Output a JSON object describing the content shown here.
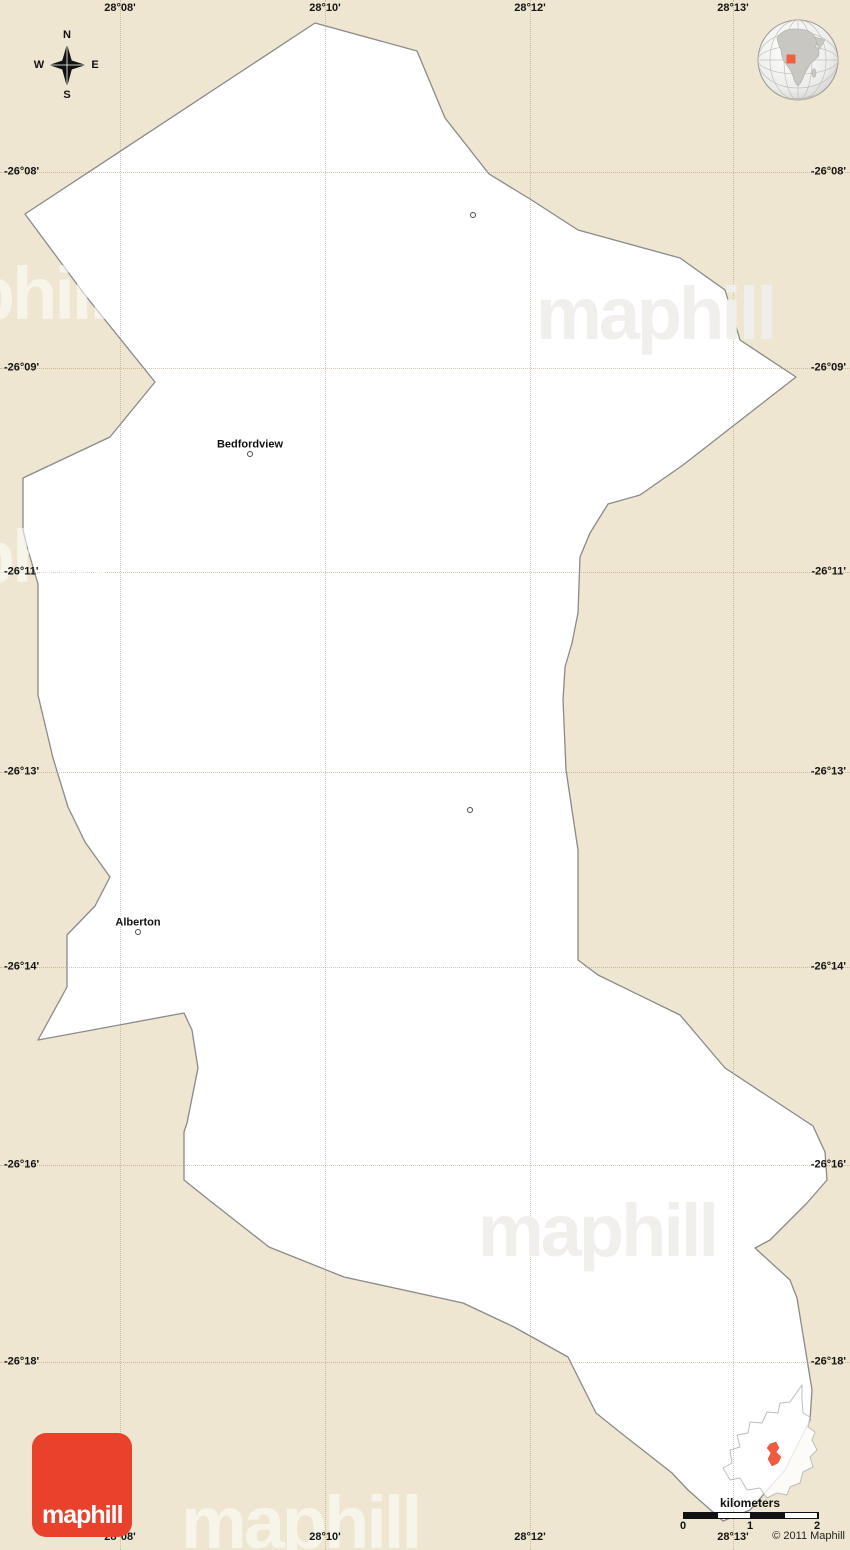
{
  "colors": {
    "background": "#EEE6D0",
    "region_fill": "#FFFFFF",
    "region_stroke": "#8A8A8C",
    "accent_red": "#E8422D",
    "highlight_red": "#F15B40"
  },
  "watermark_text": "maphill",
  "watermarks": [
    {
      "x": 655,
      "y": 315,
      "tone": "on_white"
    },
    {
      "x": -12,
      "y": 295,
      "tone": "on_beige"
    },
    {
      "x": -12,
      "y": 558,
      "tone": "on_beige"
    },
    {
      "x": 597,
      "y": 1232,
      "tone": "on_white"
    },
    {
      "x": 300,
      "y": 1524,
      "tone": "on_beige"
    }
  ],
  "compass": {
    "north": "N",
    "south": "S",
    "east": "E",
    "west": "W"
  },
  "grid": {
    "meridians": [
      {
        "label": "28°08'",
        "x": 120
      },
      {
        "label": "28°10'",
        "x": 325
      },
      {
        "label": "28°12'",
        "x": 530
      },
      {
        "label": "28°13'",
        "x": 733
      }
    ],
    "parallels": [
      {
        "label": "-26°08'",
        "y": 172
      },
      {
        "label": "-26°09'",
        "y": 368
      },
      {
        "label": "-26°11'",
        "y": 572
      },
      {
        "label": "-26°13'",
        "y": 772
      },
      {
        "label": "-26°14'",
        "y": 967
      },
      {
        "label": "-26°16'",
        "y": 1165
      },
      {
        "label": "-26°18'",
        "y": 1362
      }
    ]
  },
  "places": [
    {
      "name": "Bedfordview",
      "x": 250,
      "y": 445,
      "dot_x": 250,
      "dot_y": 454
    },
    {
      "name": "Alberton",
      "x": 138,
      "y": 923,
      "dot_x": 138,
      "dot_y": 932
    }
  ],
  "markers": [
    {
      "x": 473,
      "y": 215
    },
    {
      "x": 470,
      "y": 810
    }
  ],
  "region_shape": {
    "points": [
      [
        315,
        23
      ],
      [
        417,
        51
      ],
      [
        445,
        118
      ],
      [
        489,
        174
      ],
      [
        530,
        199
      ],
      [
        578,
        230
      ],
      [
        680,
        258
      ],
      [
        725,
        290
      ],
      [
        740,
        340
      ],
      [
        796,
        377
      ],
      [
        683,
        465
      ],
      [
        640,
        495
      ],
      [
        608,
        504
      ],
      [
        590,
        533
      ],
      [
        580,
        557
      ],
      [
        578,
        613
      ],
      [
        572,
        643
      ],
      [
        565,
        667
      ],
      [
        563,
        700
      ],
      [
        566,
        770
      ],
      [
        578,
        850
      ],
      [
        578,
        960
      ],
      [
        598,
        975
      ],
      [
        680,
        1015
      ],
      [
        725,
        1068
      ],
      [
        813,
        1126
      ],
      [
        825,
        1152
      ],
      [
        827,
        1180
      ],
      [
        807,
        1203
      ],
      [
        770,
        1240
      ],
      [
        755,
        1248
      ],
      [
        790,
        1280
      ],
      [
        797,
        1298
      ],
      [
        812,
        1390
      ],
      [
        810,
        1420
      ],
      [
        785,
        1470
      ],
      [
        750,
        1510
      ],
      [
        723,
        1521
      ],
      [
        688,
        1490
      ],
      [
        672,
        1473
      ],
      [
        621,
        1433
      ],
      [
        596,
        1413
      ],
      [
        568,
        1357
      ],
      [
        514,
        1327
      ],
      [
        463,
        1303
      ],
      [
        344,
        1277
      ],
      [
        269,
        1247
      ],
      [
        209,
        1200
      ],
      [
        184,
        1180
      ],
      [
        184,
        1132
      ],
      [
        187,
        1123
      ],
      [
        198,
        1068
      ],
      [
        192,
        1030
      ],
      [
        184,
        1013
      ],
      [
        38,
        1040
      ],
      [
        67,
        987
      ],
      [
        67,
        935
      ],
      [
        95,
        906
      ],
      [
        110,
        877
      ],
      [
        85,
        842
      ],
      [
        68,
        807
      ],
      [
        53,
        758
      ],
      [
        38,
        695
      ],
      [
        38,
        584
      ],
      [
        28,
        550
      ],
      [
        23,
        530
      ],
      [
        23,
        478
      ],
      [
        110,
        437
      ],
      [
        155,
        382
      ],
      [
        85,
        295
      ],
      [
        25,
        214
      ]
    ]
  },
  "inset": {
    "outline": [
      [
        802,
        1385
      ],
      [
        790,
        1402
      ],
      [
        780,
        1403
      ],
      [
        778,
        1413
      ],
      [
        767,
        1412
      ],
      [
        762,
        1423
      ],
      [
        750,
        1422
      ],
      [
        748,
        1433
      ],
      [
        737,
        1435
      ],
      [
        740,
        1447
      ],
      [
        730,
        1450
      ],
      [
        732,
        1463
      ],
      [
        723,
        1468
      ],
      [
        730,
        1480
      ],
      [
        740,
        1478
      ],
      [
        747,
        1490
      ],
      [
        760,
        1488
      ],
      [
        767,
        1498
      ],
      [
        777,
        1493
      ],
      [
        787,
        1495
      ],
      [
        790,
        1487
      ],
      [
        800,
        1483
      ],
      [
        803,
        1472
      ],
      [
        813,
        1467
      ],
      [
        810,
        1457
      ],
      [
        817,
        1450
      ],
      [
        812,
        1440
      ],
      [
        815,
        1432
      ],
      [
        808,
        1427
      ],
      [
        810,
        1417
      ],
      [
        803,
        1413
      ],
      [
        802,
        1400
      ]
    ],
    "highlight": [
      [
        770,
        1444
      ],
      [
        776,
        1442
      ],
      [
        779,
        1448
      ],
      [
        776,
        1452
      ],
      [
        781,
        1457
      ],
      [
        778,
        1463
      ],
      [
        772,
        1466
      ],
      [
        768,
        1459
      ],
      [
        771,
        1453
      ],
      [
        767,
        1448
      ]
    ]
  },
  "scale_bar": {
    "title": "kilometers",
    "ticks": [
      {
        "label": "0",
        "x": 683
      },
      {
        "label": "1",
        "x": 750
      },
      {
        "label": "2",
        "x": 817
      }
    ]
  },
  "footer": {
    "copyright": "© 2011 Maphill"
  },
  "logo": {
    "text": "maphill"
  }
}
